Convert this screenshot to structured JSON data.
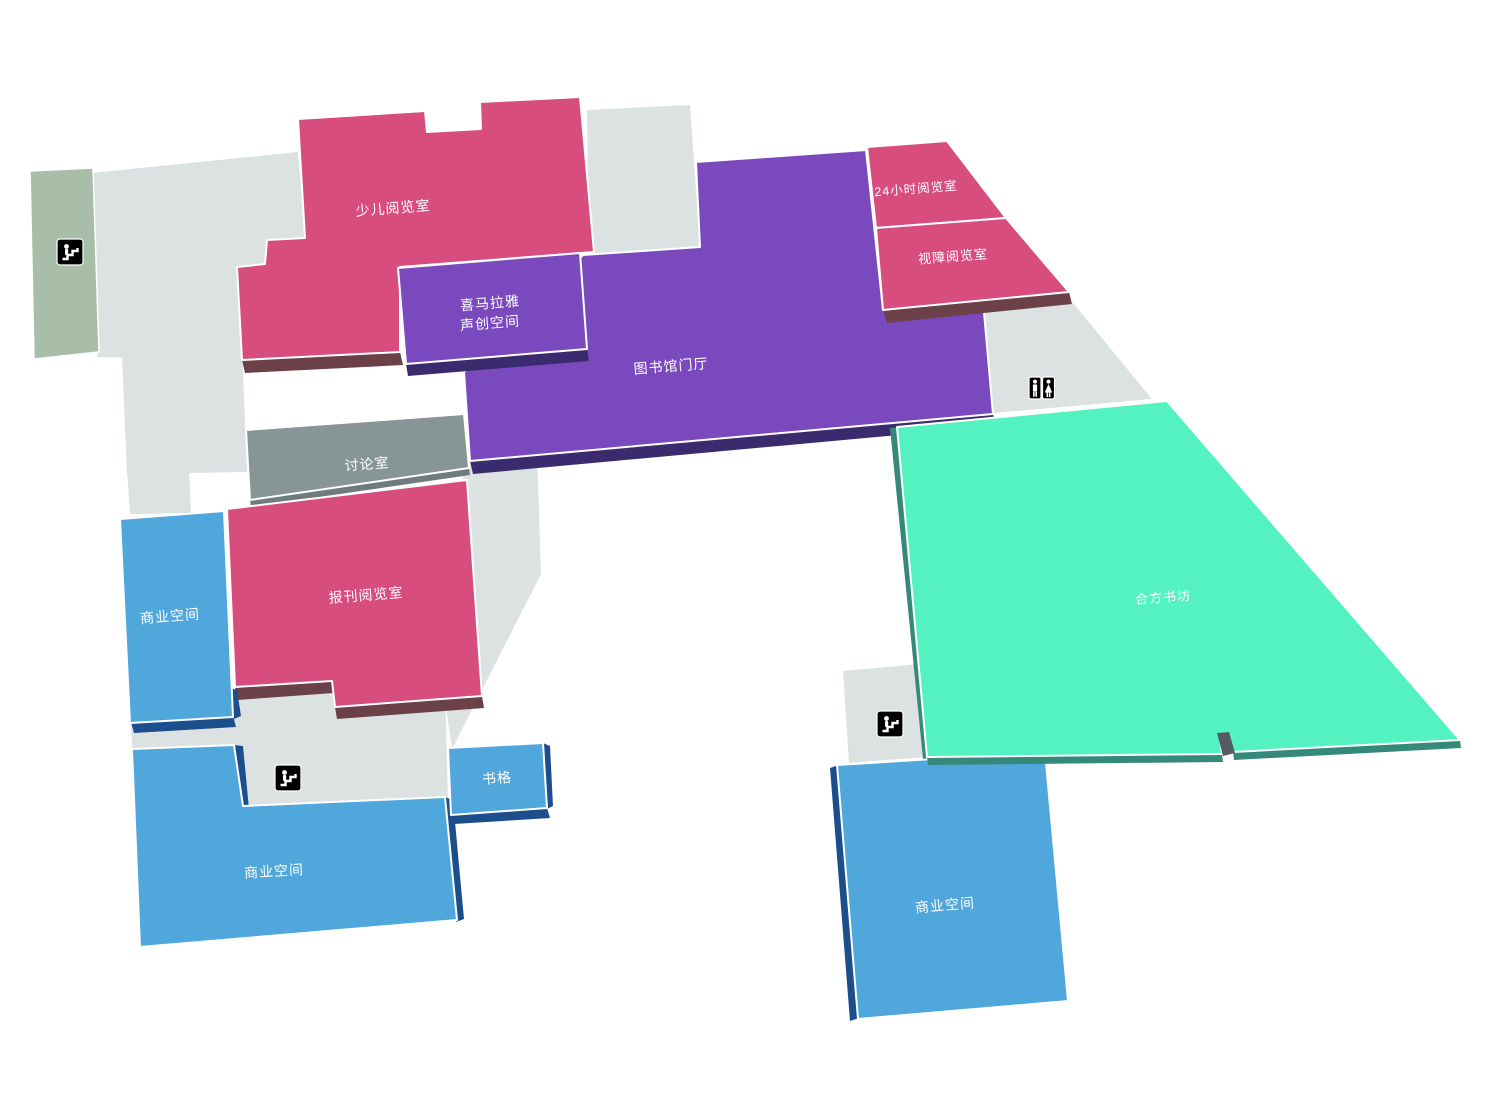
{
  "page": {
    "type": "library-floor-plan",
    "background": "#ffffff"
  },
  "rooms": {
    "children_reading_room": {
      "label": "少儿阅览室",
      "color": "#d64d7e"
    },
    "himalaya_sound_space": {
      "line1": "喜马拉雅",
      "line2": "声创空间",
      "color": "#7b49be"
    },
    "library_lobby": {
      "label": "图书馆门厅",
      "color": "#7b49be"
    },
    "reading_room_24h": {
      "label": "24小时阅览室",
      "color": "#d64d7e"
    },
    "visually_impaired_reading_room": {
      "label": "视障阅览室",
      "color": "#d64d7e"
    },
    "discussion_room": {
      "label": "讨论室",
      "color": "#879597"
    },
    "periodicals_reading_room": {
      "label": "报刊阅览室",
      "color": "#d64d7e"
    },
    "commercial_space_left": {
      "label": "商业空间",
      "color": "#4fa7db"
    },
    "commercial_space_bottom_left": {
      "label": "商业空间",
      "color": "#4fa7db"
    },
    "commercial_space_bottom_right": {
      "label": "商业空间",
      "color": "#4fa7db"
    },
    "book_grid": {
      "label": "书格",
      "color": "#4fa7db"
    },
    "hefang_bookshop": {
      "label": "合方书坊",
      "color": "#55f2c1"
    }
  },
  "floor": {
    "base_color": "#dbe2e1",
    "accent_strip_color": "#a8bea9"
  },
  "shadow_colors": {
    "pink_extrusion": "#6b4049",
    "purple_extrusion": "#3a2a6e",
    "blue_extrusion": "#1c4e8c",
    "teal_extrusion": "#35897a",
    "gray_extrusion": "#6e7c7e",
    "step_face": "#535c63"
  },
  "icons": {
    "escalator": "escalator-icon",
    "restroom": "restroom-icon"
  }
}
